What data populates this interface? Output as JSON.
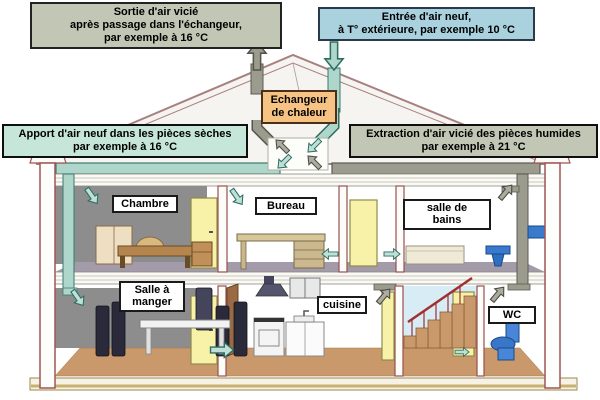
{
  "diagram": {
    "callouts": {
      "sortie": [
        "Sortie d'air vicié",
        "après passage dans l'échangeur,",
        "par exemple à 16 °C"
      ],
      "entree": [
        "Entrée d'air neuf,",
        "à T° extérieure, par exemple 10 °C"
      ],
      "apport": [
        "Apport d'air neuf dans les pièces sèches",
        "par exemple à 16 °C"
      ],
      "extraction": [
        "Extraction d'air vicié des pièces humides",
        "par exemple à 21 °C"
      ],
      "echangeur": [
        "Echangeur",
        "de chaleur"
      ]
    },
    "rooms": {
      "chambre": "Chambre",
      "bureau": "Bureau",
      "salle_de_bains": [
        "salle de",
        "bains"
      ],
      "salle_a_manger": [
        "Salle à",
        "manger"
      ],
      "cuisine": "cuisine",
      "wc": "WC"
    },
    "colors": {
      "callout_gray_green": "#C2C6B4",
      "callout_blue": "#A9D2DE",
      "callout_teal": "#C6E6DA",
      "exchanger_orange": "#F6C385",
      "supply_duct_teal": "#AFD6CB",
      "exhaust_duct_gray": "#9C9C8E",
      "floor_tan": "#C9996B",
      "wall_outline_maroon": "#A05555",
      "back_wall_gray": "#8D8D8D"
    }
  }
}
